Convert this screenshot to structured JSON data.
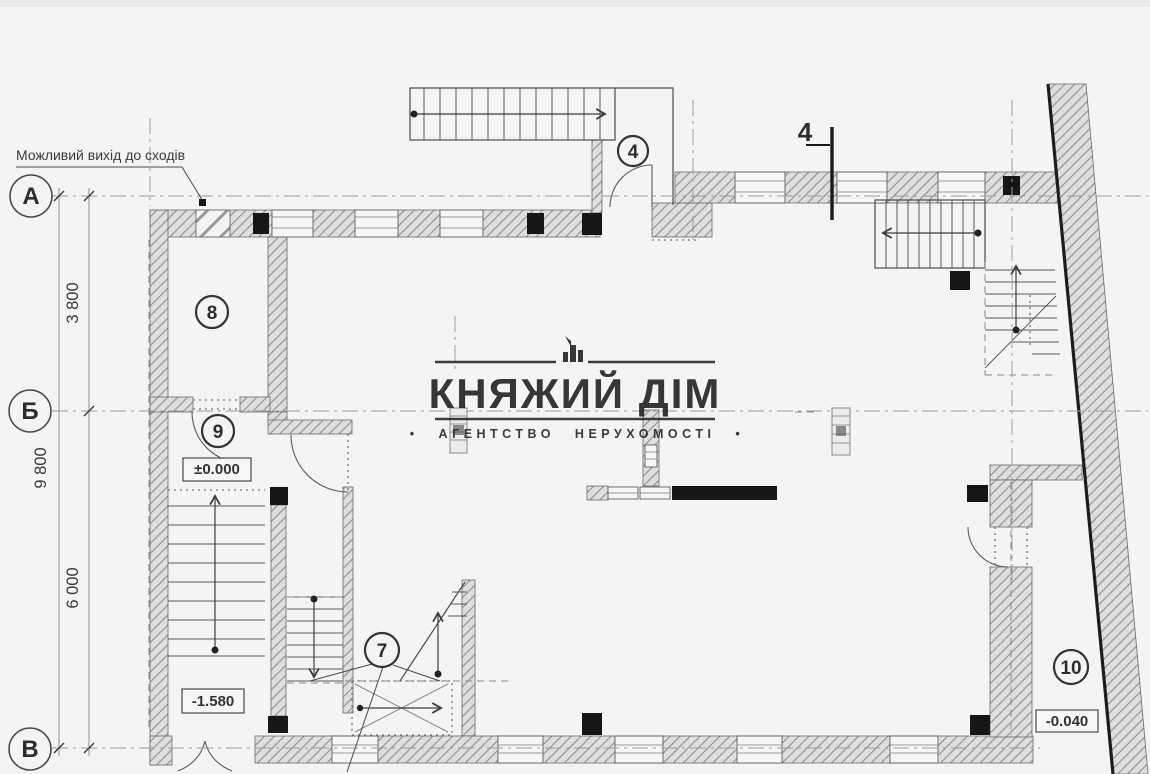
{
  "page": {
    "background": "#f4f4f4",
    "top_strip": "#eaeaea"
  },
  "note": {
    "text": "Можливий вихід до сходів"
  },
  "section_mark": {
    "label": "4"
  },
  "grid": {
    "rows": [
      {
        "id": "A",
        "label": "А"
      },
      {
        "id": "B",
        "label": "Б"
      },
      {
        "id": "V",
        "label": "В"
      }
    ]
  },
  "dimensions": {
    "segment_a_b": "3 800",
    "segment_b_v": "6 000",
    "total": "9 800"
  },
  "rooms": [
    {
      "number": "4"
    },
    {
      "number": "7"
    },
    {
      "number": "8"
    },
    {
      "number": "9"
    },
    {
      "number": "10"
    }
  ],
  "elevations": {
    "ground_floor": "±0.000",
    "stair_landing": "-1.580",
    "entrance": "-0.040"
  },
  "watermark": {
    "title": "КНЯЖИЙ ДІМ",
    "subtitle": "• АГЕНТСТВО НЕРУХОМОСТІ •",
    "color": "#262626"
  },
  "colors": {
    "wall_fill": "#dedede",
    "wall_hatch": "#8f8f8f",
    "column": "#161616",
    "axis_line": "#9c9c9c"
  }
}
